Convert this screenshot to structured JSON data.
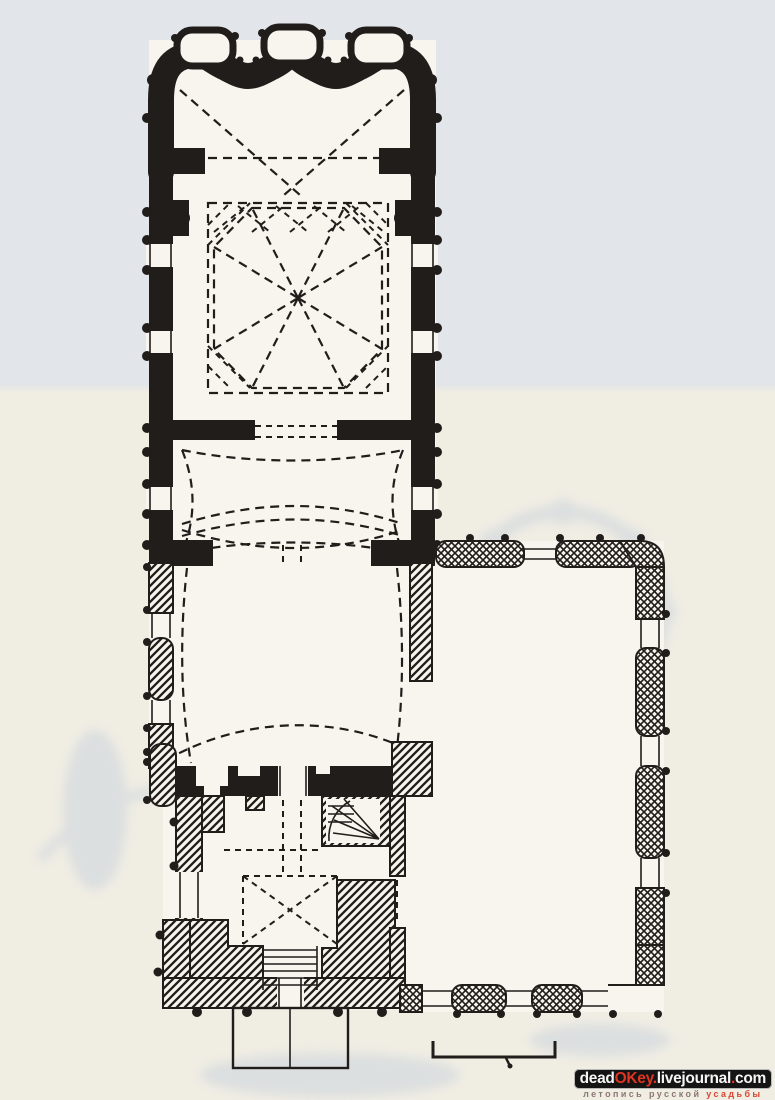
{
  "colors": {
    "ink": "#201d1b",
    "paper_top": "#e2e5e9",
    "paper_bottom": "#f0ede3",
    "paper_inner": "#f7f5ee",
    "ghost_blue": "#a9bcd8",
    "wm_bg": "#141414",
    "wm_text": "#f5f5f5",
    "wm_accent": "#e03322",
    "tagline_muted": "#8d7676",
    "tagline_red": "#da4430"
  },
  "diagram": {
    "type": "architectural-floor-plan",
    "parts": [
      {
        "id": "apse",
        "label": "apse"
      },
      {
        "id": "sanctuary-bay",
        "label": "sanctuary bay"
      },
      {
        "id": "quadrangle",
        "label": "main quadrangle with octagonal vault"
      },
      {
        "id": "refectory-east-bay",
        "label": "refectory east bay"
      },
      {
        "id": "refectory",
        "label": "refectory"
      },
      {
        "id": "west-wall",
        "label": "refectory west wall"
      },
      {
        "id": "bell-tower",
        "label": "bell tower"
      },
      {
        "id": "straight-staircase",
        "label": "straight staircase"
      },
      {
        "id": "spiral-staircase",
        "label": "spiral staircase"
      },
      {
        "id": "porch",
        "label": "porch"
      },
      {
        "id": "annex",
        "label": "side annex"
      },
      {
        "id": "scale-bar",
        "label": "scale bar"
      },
      {
        "id": "ghost",
        "label": "page bleed-through"
      }
    ]
  },
  "watermark": {
    "site": {
      "part1": "dead",
      "part2": "OKey",
      "dot1": ".",
      "part3": "livejournal",
      "dot2": ".",
      "part4": "com"
    },
    "tagline": {
      "part1": "летопись русской",
      "part2": "усадьбы"
    }
  }
}
